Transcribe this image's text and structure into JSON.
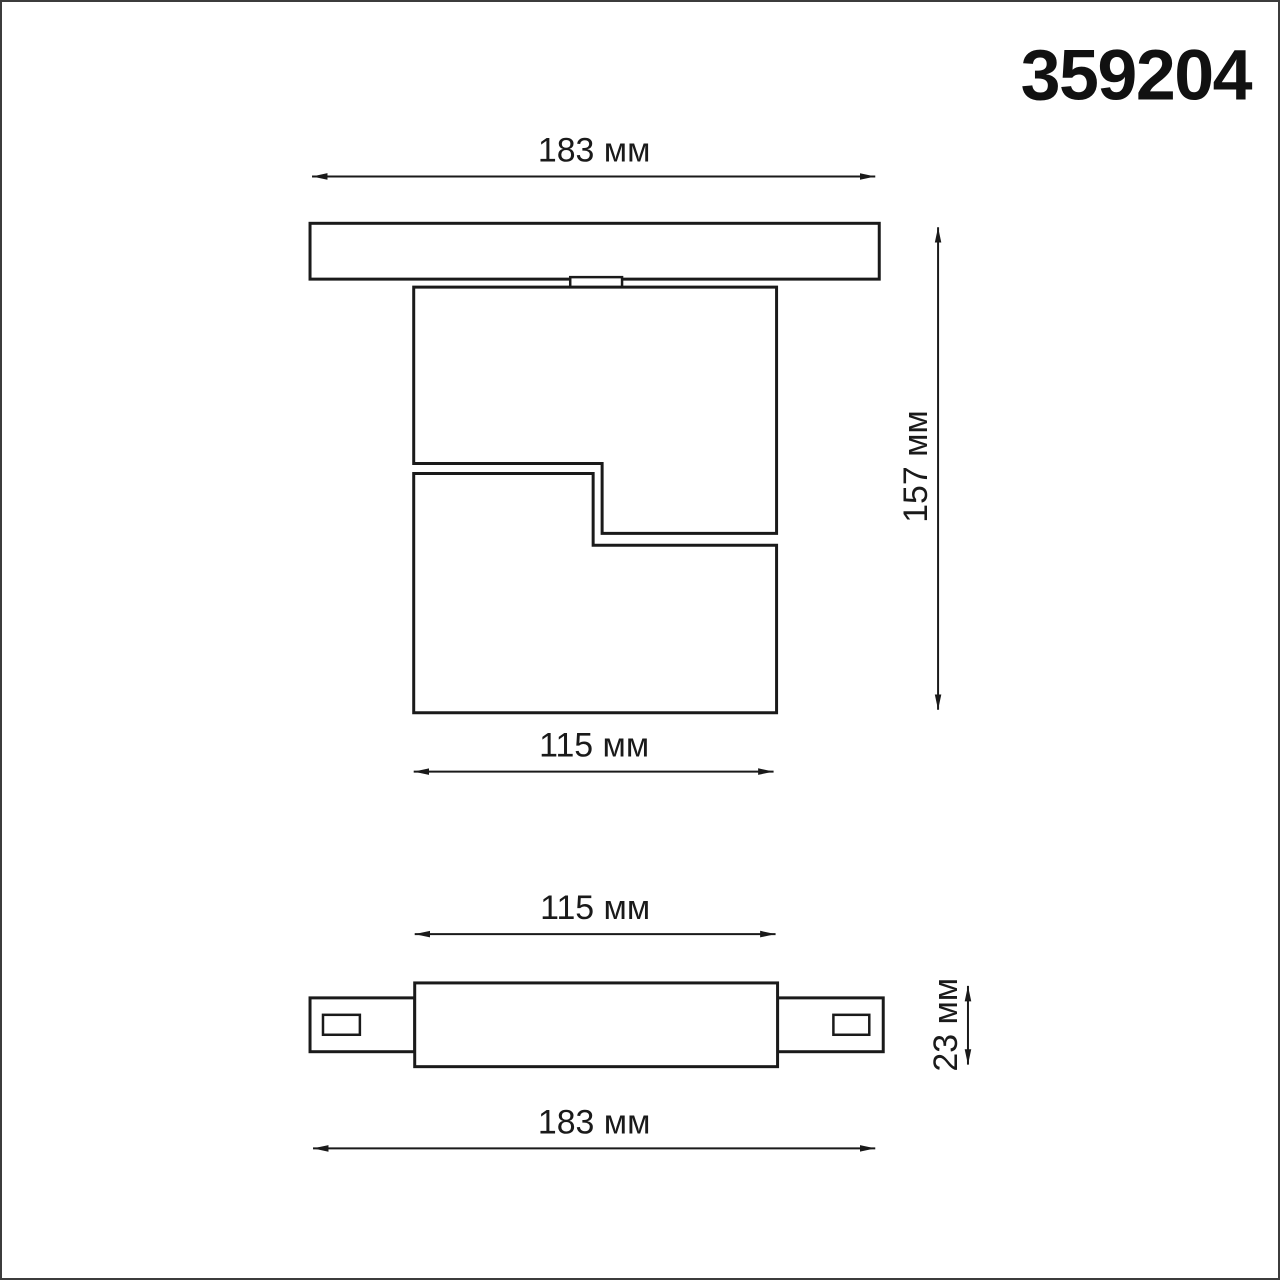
{
  "header": {
    "product_code": "359204"
  },
  "side_view": {
    "track_width_label": "183 мм",
    "overall_height_label": "157 мм",
    "body_width_label": "115 мм"
  },
  "bottom_view": {
    "body_width_label": "115 мм",
    "body_depth_label": "23 мм",
    "track_width_label": "183 мм"
  },
  "colors": {
    "line": "#1a1a1a",
    "background": "#ffffff",
    "frame": "#3c3c3c"
  }
}
